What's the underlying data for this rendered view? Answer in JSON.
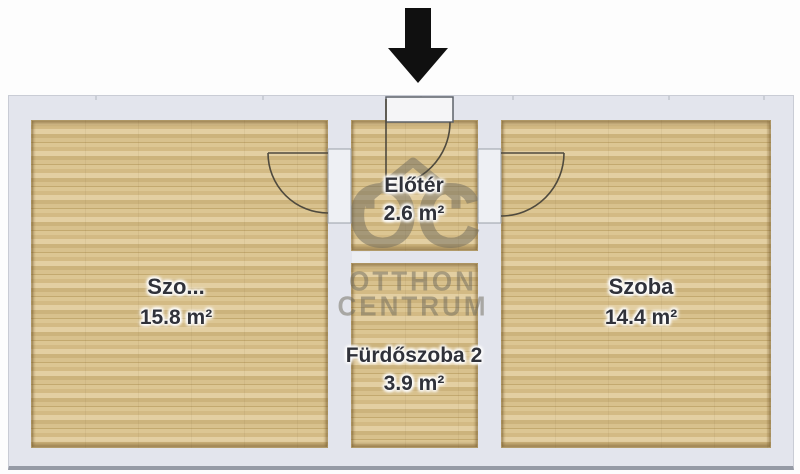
{
  "plan_title": "floor-plan",
  "arrow": {
    "meaning": "entrance-direction"
  },
  "watermark": {
    "logo": "OC",
    "line1": "OTTHON",
    "line2": "CENTRUM"
  },
  "rooms": [
    {
      "name": "Szo...",
      "area": "15.8 m²",
      "position": "left"
    },
    {
      "name": "Előtér",
      "area": "2.6 m²",
      "position": "top-middle"
    },
    {
      "name": "Fürdőszoba 2",
      "area": "3.9 m²",
      "position": "bottom-middle"
    },
    {
      "name": "Szoba",
      "area": "14.4 m²",
      "position": "right"
    }
  ],
  "colors": {
    "floor_wood": "#d8c18d",
    "wall": "#e3e5ed",
    "arrow": "#101010",
    "label_text": "#30323a",
    "watermark": "#6f6b5e",
    "door_stroke": "#4f4a3e"
  }
}
